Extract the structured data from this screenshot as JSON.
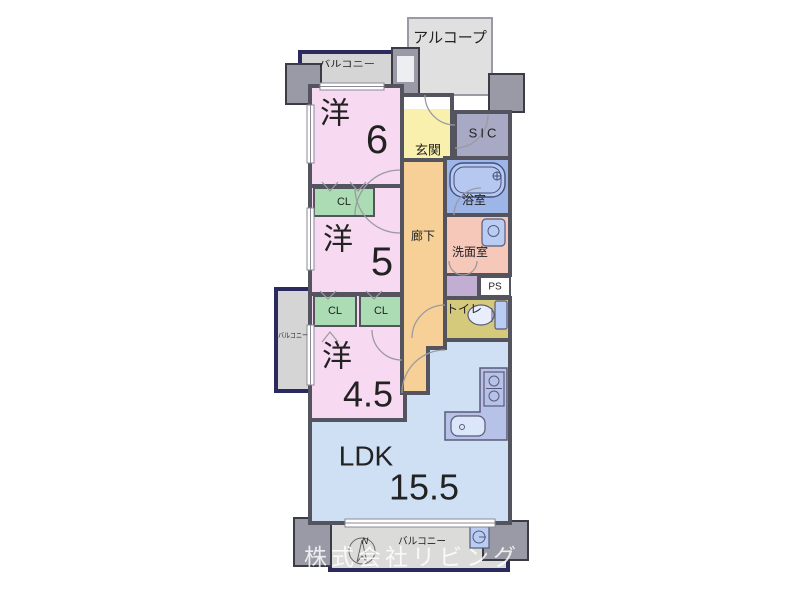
{
  "colors": {
    "wall": "#54545e",
    "navy_outline": "#2a2a5e",
    "room_pink": "#f7daf1",
    "closet_green": "#abdcb3",
    "ldk_blue": "#cfe0f4",
    "entry_yellow": "#faf0ae",
    "hallway_orange": "#f6d096",
    "bath_blue": "#9eb5e7",
    "tub_blue": "#b6c8ef",
    "washroom_salmon": "#f5c8ba",
    "toilet_khaki": "#d5c97b",
    "sic_gray": "#a8a9c4",
    "balcony_gray": "#d5d5d5",
    "balcony_bottom_gray": "#dbdbd9",
    "alcove_gray": "#e0e0e0",
    "column_gray": "#9a9aa6",
    "kitchen_counter": "#b7c2e9",
    "storage_purple": "#c3aed3",
    "fixture_blue": "#b9ccf4",
    "white": "#ffffff"
  },
  "rooms": {
    "alcove": {
      "label": "アルコープ"
    },
    "balcony_top": {
      "label": "バルコニー"
    },
    "balcony_left": {
      "label": "バルコニー"
    },
    "balcony_bottom": {
      "label": "バルコニー"
    },
    "bedroom6": {
      "label": "洋",
      "size": "6"
    },
    "bedroom5": {
      "label": "洋",
      "size": "5"
    },
    "bedroom45": {
      "label": "洋",
      "size": "4.5"
    },
    "ldk": {
      "label": "LDK",
      "size": "15.5"
    },
    "entry": {
      "label": "玄関"
    },
    "sic": {
      "label": "SIC"
    },
    "bath": {
      "label": "浴室"
    },
    "washroom": {
      "label": "洗面室"
    },
    "hallway": {
      "label": "廊下"
    },
    "toilet": {
      "label": "トイレ"
    },
    "ps": {
      "label": "PS"
    },
    "closet": {
      "label": "CL"
    }
  },
  "compass": {
    "north_label": "N"
  },
  "watermark": {
    "text": "株式会社リビング"
  }
}
